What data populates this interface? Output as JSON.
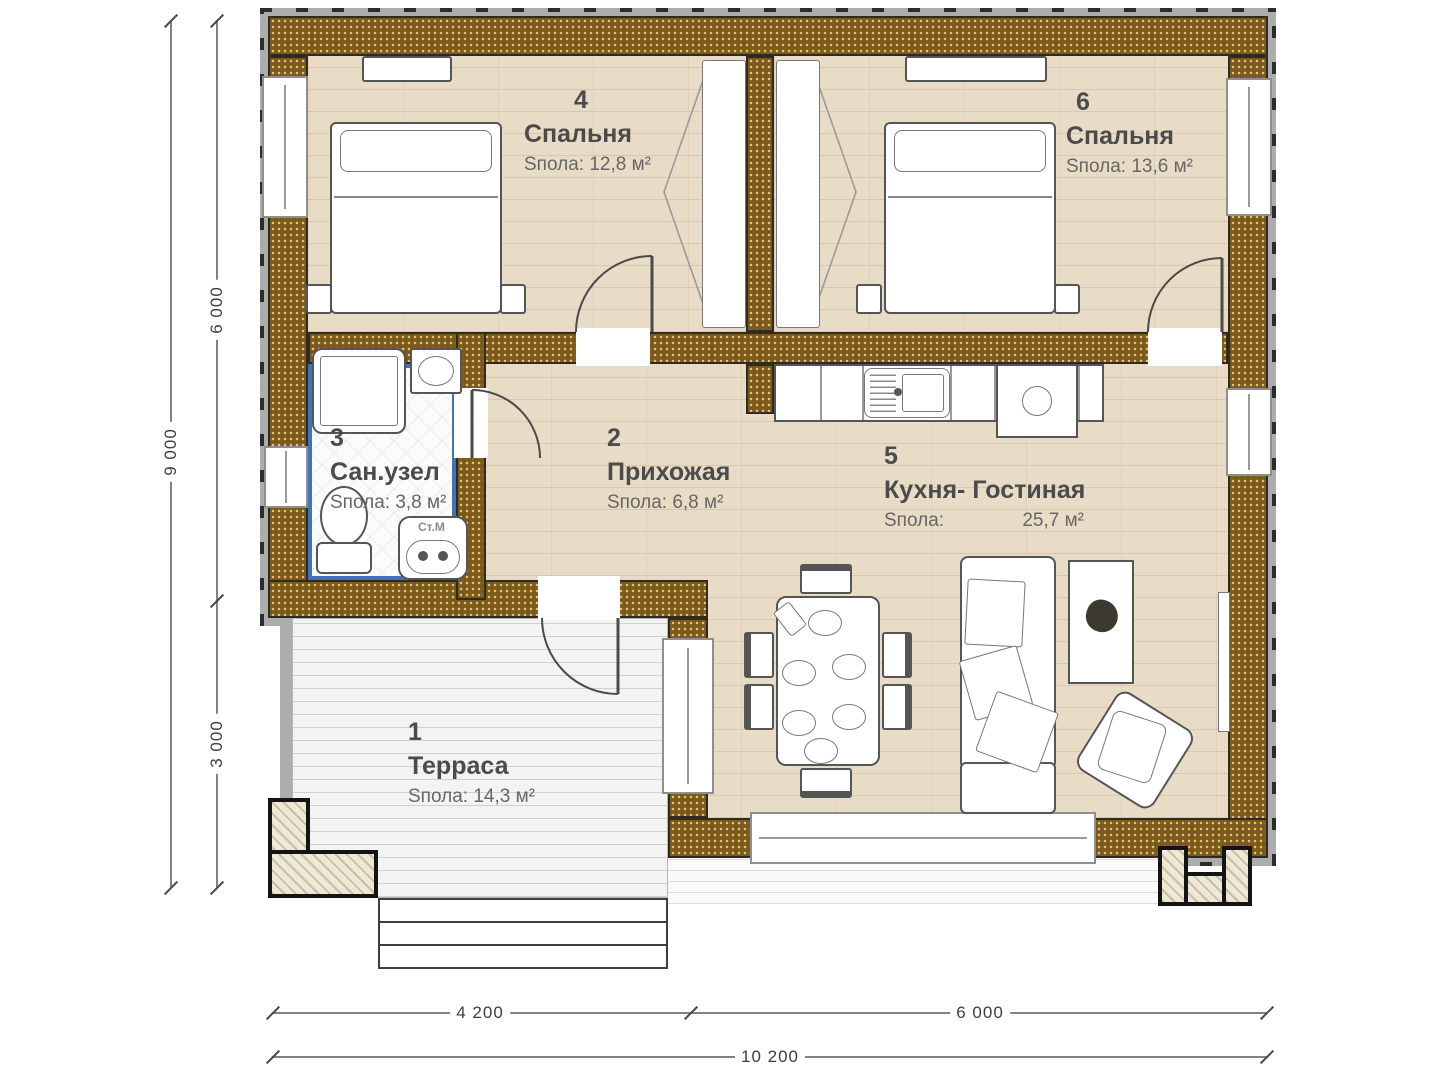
{
  "plan_title": "one-storey house floor plan",
  "rooms": {
    "bedroom4": {
      "number": "4",
      "name": "Спальня",
      "area": "Sпола: 12,8 м²"
    },
    "bedroom6": {
      "number": "6",
      "name": "Спальня",
      "area": "Sпола: 13,6 м²"
    },
    "bathroom": {
      "number": "3",
      "name": "Сан.узел",
      "area": "Sпола: 3,8 м²"
    },
    "hallway": {
      "number": "2",
      "name": "Прихожая",
      "area": "Sпола: 6,8 м²"
    },
    "kitchen_living": {
      "number": "5",
      "name": "Кухня- Гостиная",
      "area_prefix": "Sпола:",
      "area_value": "25,7 м²"
    },
    "terrace": {
      "number": "1",
      "name": "Терраса",
      "area": "Sпола: 14,3 м²"
    }
  },
  "appliance_labels": {
    "washing_machine": "Ст.М"
  },
  "dimensions": {
    "left_total": "9 000",
    "left_upper": "6 000",
    "left_lower": "3 000",
    "bottom_left": "4 200",
    "bottom_right": "6 000",
    "bottom_total": "10 200"
  },
  "colors": {
    "wall_brown": "#7a591d",
    "wall_dot": "#ebc578",
    "wood_floor": "#e9dcc7",
    "bathroom_accent_blue": "#4272b8",
    "terrace_floor": "#f3f3f1",
    "outer_band_gray": "#acacac",
    "text_gray": "#4b4b4b"
  }
}
